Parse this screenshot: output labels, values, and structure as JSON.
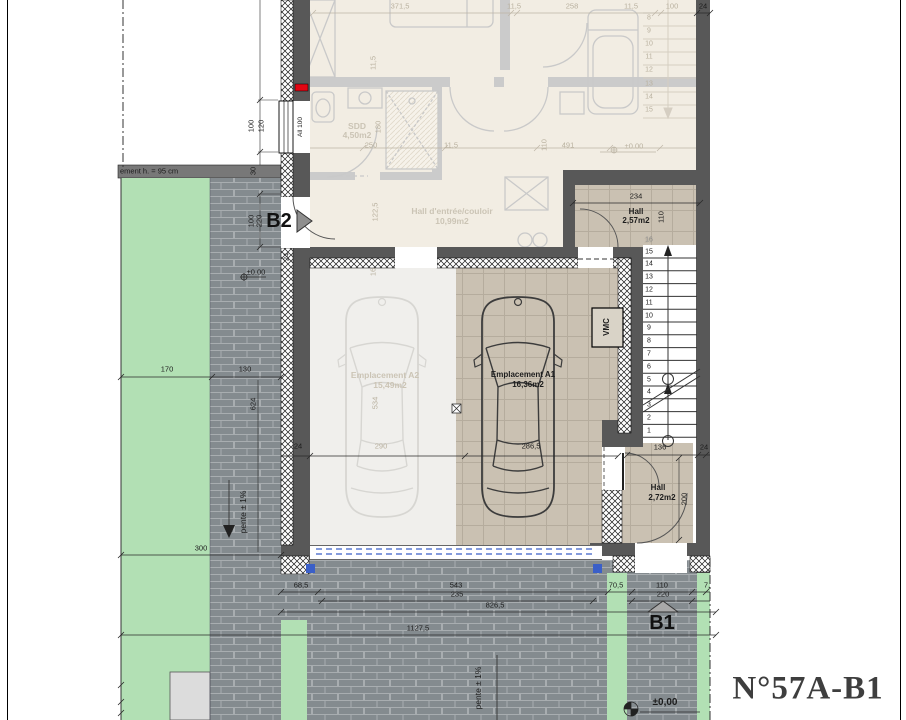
{
  "title_block": {
    "plan_number": "N°57A-B1"
  },
  "markers": {
    "b1": "B1",
    "b2": "B2"
  },
  "rooms": {
    "hall_upper": {
      "name": "Hall",
      "area": "2,57m2"
    },
    "hall_lower": {
      "name": "Hall",
      "area": "2,72m2"
    },
    "parking_a1": {
      "name": "Emplacement A1",
      "area": "16,36m2"
    },
    "parking_a2": {
      "name": "Emplacement A2",
      "area": "15,49m2"
    },
    "sdd": {
      "name": "SDD",
      "area": "4,50m2"
    },
    "entry_hall": {
      "name": "Hall d'entrée/couloir",
      "area": "10,99m2"
    }
  },
  "equipment": {
    "vmc": "VMC",
    "window_label": "All 100"
  },
  "annotations": {
    "wall_note": "ement h. = 95 cm",
    "slope_note_left": "pente ± 1%",
    "slope_note_bottom": "pente ± 1%",
    "level_main": "±0,00",
    "level_left": "±0.00",
    "level_ghost": "±0.00"
  },
  "stairs": {
    "active_steps": [
      "15",
      "14",
      "13",
      "12",
      "11",
      "10",
      "9",
      "8",
      "7",
      "6",
      "5",
      "4",
      "3",
      "2",
      "1"
    ],
    "top_step_label": "16",
    "ghost_steps": [
      "8",
      "9",
      "10",
      "11",
      "12",
      "13",
      "14",
      "15"
    ]
  },
  "dimensions": {
    "active": [
      {
        "t": "24",
        "x": 703,
        "y": 6
      },
      {
        "t": "234",
        "x": 636,
        "y": 196
      },
      {
        "t": "110",
        "x": 661,
        "y": 217,
        "r": 1
      },
      {
        "t": "136",
        "x": 660,
        "y": 447
      },
      {
        "t": "24",
        "x": 704,
        "y": 447
      },
      {
        "t": "200",
        "x": 684,
        "y": 499,
        "r": 1
      },
      {
        "t": "286,5",
        "x": 531,
        "y": 446
      },
      {
        "t": "24",
        "x": 298,
        "y": 446
      },
      {
        "t": "68,5",
        "x": 301,
        "y": 585
      },
      {
        "t": "543",
        "x": 456,
        "y": 585
      },
      {
        "t": "70,5",
        "x": 616,
        "y": 585
      },
      {
        "t": "110",
        "x": 662,
        "y": 585
      },
      {
        "t": "7,",
        "x": 707,
        "y": 585
      },
      {
        "t": "235",
        "x": 457,
        "y": 594
      },
      {
        "t": "220",
        "x": 663,
        "y": 594
      },
      {
        "t": "826,5",
        "x": 495,
        "y": 605
      },
      {
        "t": "1127,5",
        "x": 418,
        "y": 628
      },
      {
        "t": "170",
        "x": 167,
        "y": 369
      },
      {
        "t": "130",
        "x": 245,
        "y": 369
      },
      {
        "t": "300",
        "x": 201,
        "y": 548
      },
      {
        "t": "624",
        "x": 253,
        "y": 404,
        "r": 1
      },
      {
        "t": "100",
        "x": 251,
        "y": 126,
        "r": 1
      },
      {
        "t": "120",
        "x": 261,
        "y": 126,
        "r": 1
      },
      {
        "t": "100",
        "x": 251,
        "y": 221,
        "r": 1
      },
      {
        "t": "220",
        "x": 259,
        "y": 221,
        "r": 1
      },
      {
        "t": "30",
        "x": 253,
        "y": 171,
        "r": 1
      },
      {
        "t": "24",
        "x": 286,
        "y": 257,
        "r": 1
      }
    ],
    "ghost": [
      {
        "t": "371,5",
        "x": 400,
        "y": 6
      },
      {
        "t": "11,5",
        "x": 514,
        "y": 6
      },
      {
        "t": "258",
        "x": 572,
        "y": 6
      },
      {
        "t": "11,5",
        "x": 631,
        "y": 6
      },
      {
        "t": "100",
        "x": 672,
        "y": 6
      },
      {
        "t": "250",
        "x": 371,
        "y": 145
      },
      {
        "t": "11,5",
        "x": 451,
        "y": 145
      },
      {
        "t": "491",
        "x": 568,
        "y": 145
      },
      {
        "t": "110",
        "x": 544,
        "y": 145,
        "r": 1
      },
      {
        "t": "180",
        "x": 378,
        "y": 127,
        "r": 1
      },
      {
        "t": "122,5",
        "x": 375,
        "y": 212,
        "r": 1
      },
      {
        "t": "11,5",
        "x": 373,
        "y": 63,
        "r": 1
      },
      {
        "t": "16",
        "x": 373,
        "y": 272,
        "r": 1
      },
      {
        "t": "290",
        "x": 381,
        "y": 446
      },
      {
        "t": "534",
        "x": 375,
        "y": 403,
        "r": 1
      },
      {
        "t": "16",
        "x": 648,
        "y": 240
      }
    ]
  },
  "colors": {
    "wall": "#585858",
    "green": "#b2e0b4",
    "brick": "#848b8f",
    "mortar": "#a8adb0",
    "tile": "#cac1b2",
    "cream": "#f2ede3",
    "blue": "#3a5fc8",
    "red": "#e30613"
  }
}
